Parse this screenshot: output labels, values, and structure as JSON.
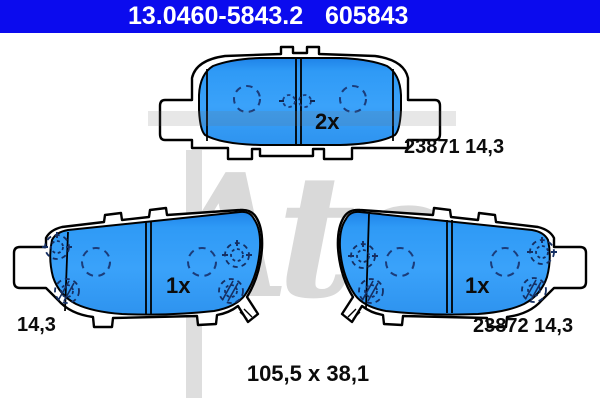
{
  "header": {
    "reference_number": "13.0460-5843.2",
    "article_number": "605843",
    "background_color": "#0b0bee",
    "text_color": "#ffffff"
  },
  "watermark": {
    "brand_text": "Ate"
  },
  "drawing": {
    "pad_color": "#2f9af6",
    "outline_color": "#000000",
    "marker_color": "#1b3c7a",
    "views": {
      "top": {
        "quantity": "2x",
        "label": "23871 14,3"
      },
      "bottom_left": {
        "quantity": "1x",
        "label": "14,3"
      },
      "bottom_right": {
        "quantity": "1x",
        "label": "23872 14,3"
      }
    },
    "dimensions_label": "105,5 x 38,1"
  }
}
